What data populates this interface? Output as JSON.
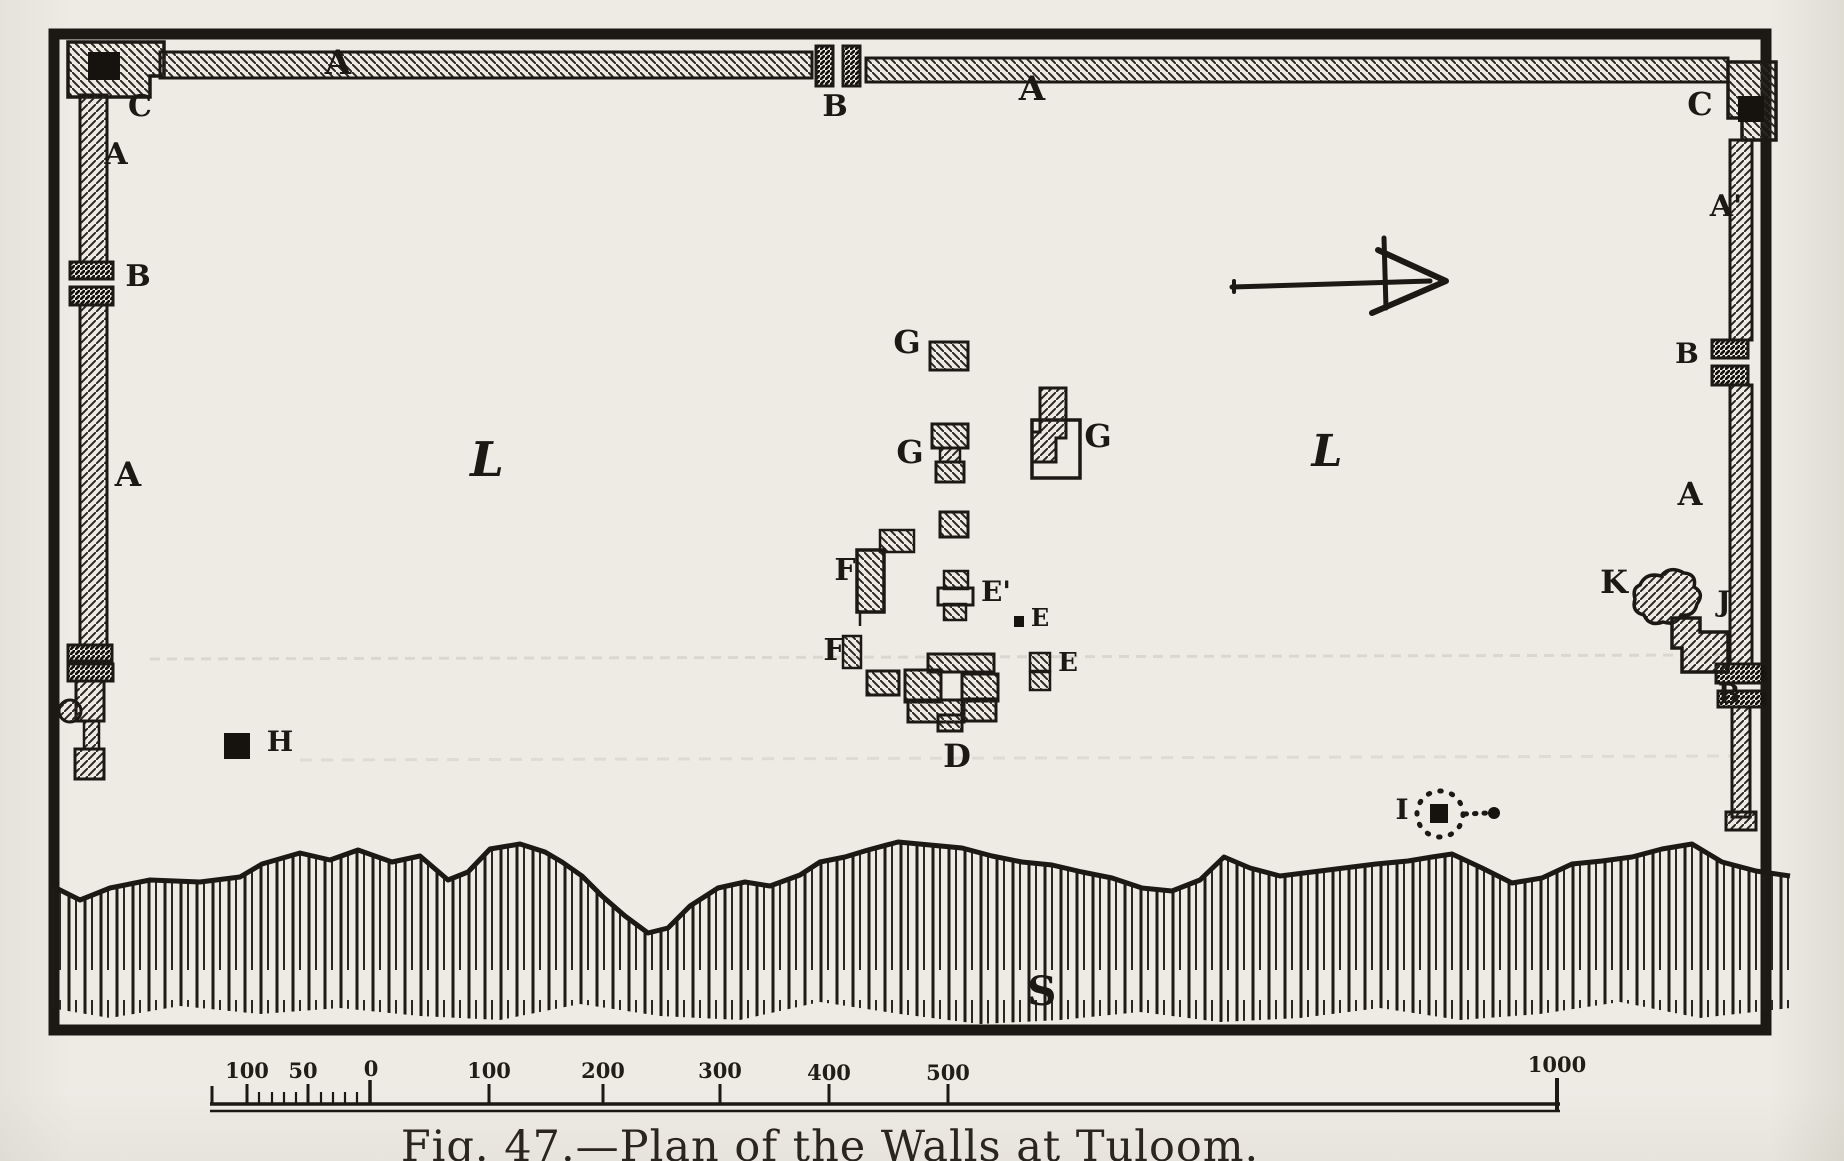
{
  "figure": {
    "caption": "Fig. 47.—Plan of the Walls at Tuloom."
  },
  "labels": {
    "c_northwest": "C",
    "a_north_west": "A",
    "b_north_gate": "B",
    "a_north_east": "A",
    "c_northeast": "C",
    "a_west_upper": "A",
    "b_west_gate": "B",
    "a_west_lower": "A",
    "a_prime_east": "A'",
    "b_east_upper": "B",
    "a_east_mid": "A",
    "b_east_lower": "B",
    "l_west": "L",
    "l_east": "L",
    "g1": "G",
    "g2": "G",
    "g3": "G",
    "f1": "F",
    "f2": "F",
    "e_prime": "E'",
    "e_mid": "E",
    "e_lower": "E",
    "d": "D",
    "h": "H",
    "k": "K",
    "j": "J",
    "i": "I",
    "s": "S"
  },
  "scale_ticks": [
    "100",
    "50",
    "0",
    "100",
    "200",
    "300",
    "400",
    "500",
    "1000"
  ]
}
